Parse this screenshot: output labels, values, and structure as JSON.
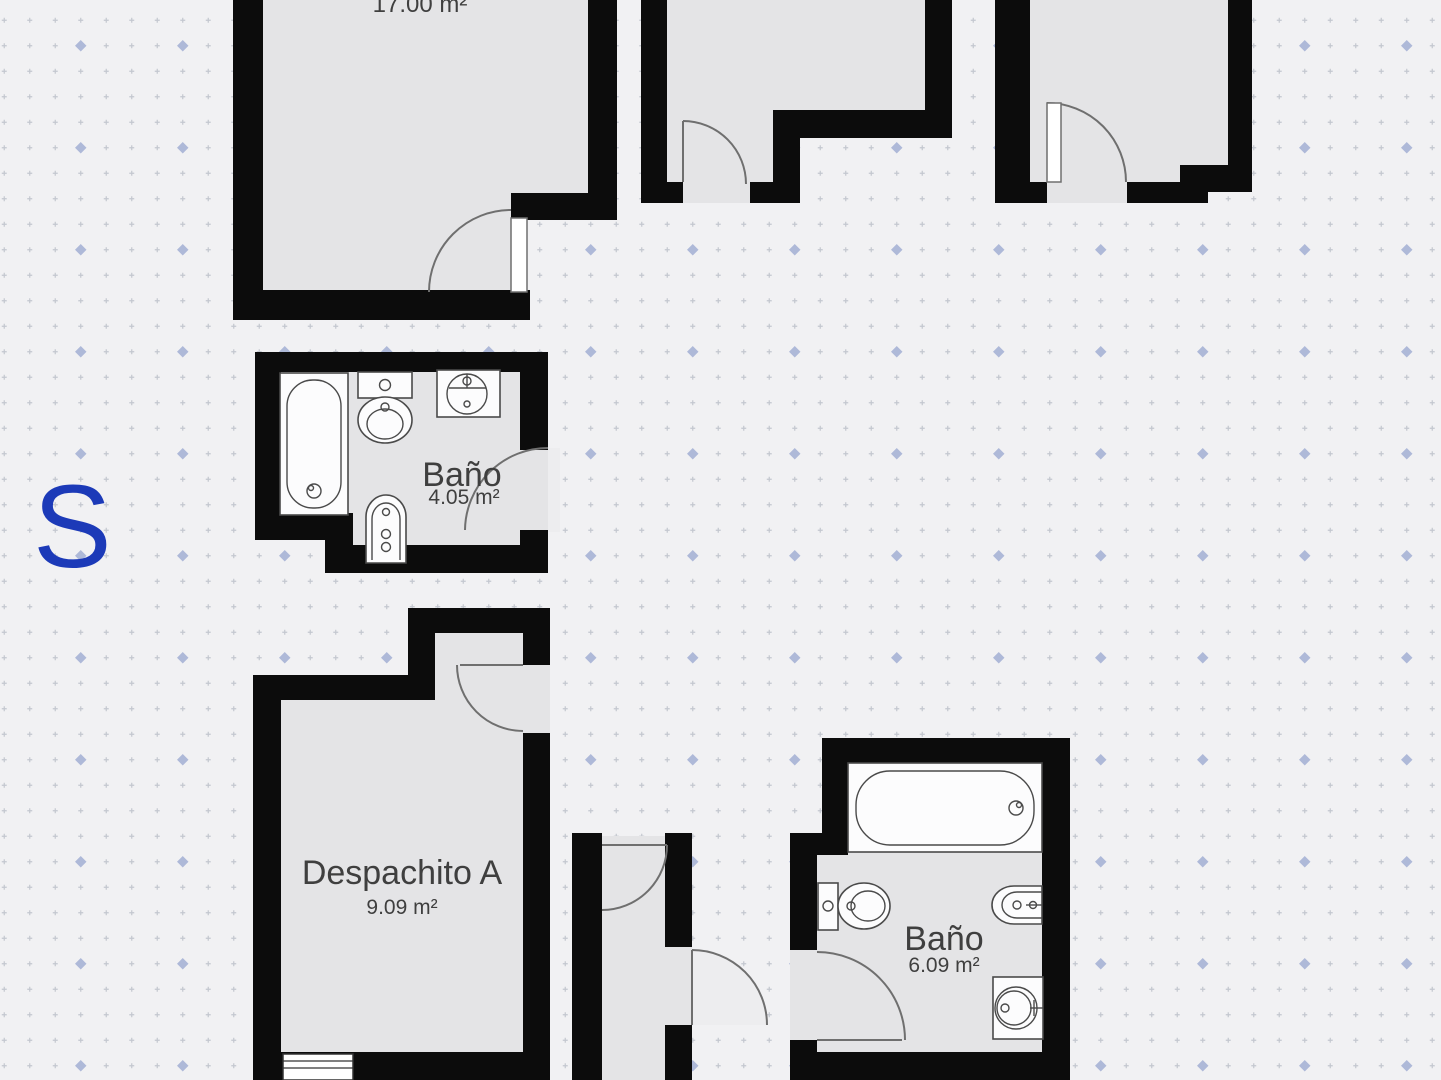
{
  "watermark": {
    "letter": "S"
  },
  "rooms": {
    "top_left": {
      "area": "17.00 m²"
    },
    "bathroom_top": {
      "name": "Baño",
      "area": "4.05 m²"
    },
    "office_a": {
      "name": "Despachito A",
      "area": "9.09 m²"
    },
    "bathroom_bottom": {
      "name": "Baño",
      "area": "6.09 m²"
    }
  },
  "fixtures": {
    "bathroom_top": [
      "bathtub",
      "toilet",
      "sink",
      "bidet"
    ],
    "bathroom_bottom": [
      "bathtub",
      "toilet",
      "bidet",
      "sink"
    ]
  },
  "colors": {
    "background": "#f1f1f3",
    "room_fill": "#e4e4e6",
    "wall": "#0c0c0c",
    "dot_small": "#c3c7cf",
    "dot_large": "#aeb9d8",
    "fixture_fill": "#fcfcfd",
    "fixture_stroke": "#4a4a4a",
    "door_stroke": "#6f6f6f",
    "swing_fill": "#ededef",
    "text": "#3f3f3f",
    "watermark_blue": "#1c3ab8"
  }
}
